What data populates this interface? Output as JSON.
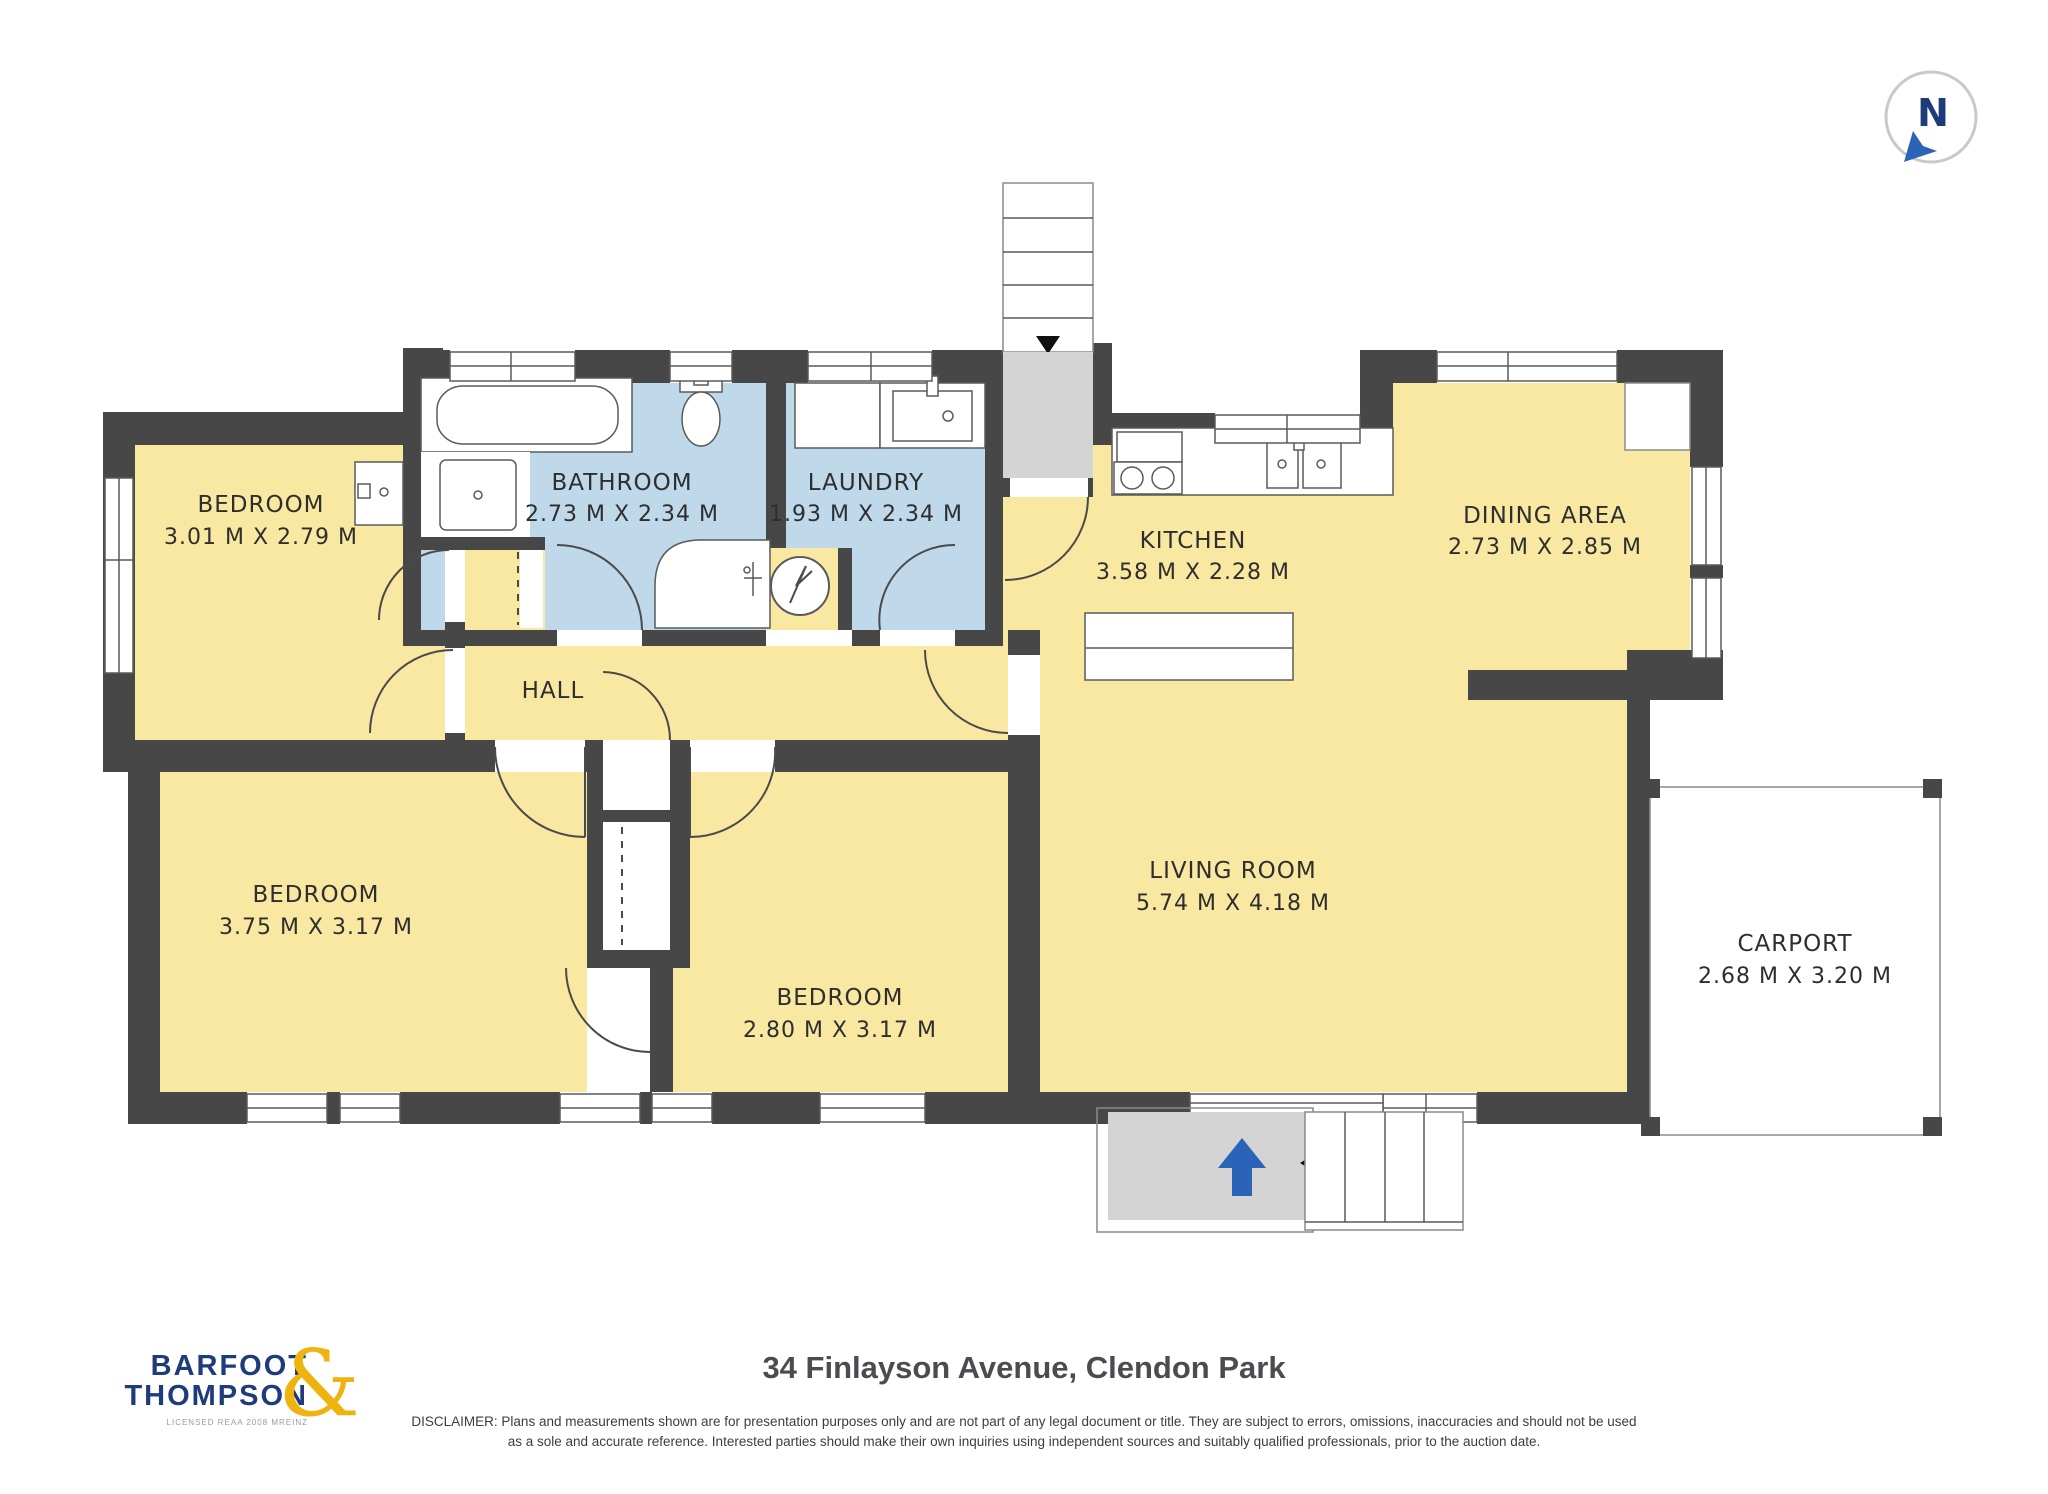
{
  "compass": {
    "label": "N"
  },
  "rooms": [
    {
      "name": "BEDROOM",
      "dims": "3.01 M X 2.79 M"
    },
    {
      "name": "BATHROOM",
      "dims": "2.73 M X 2.34 M"
    },
    {
      "name": "LAUNDRY",
      "dims": "1.93 M X 2.34 M"
    },
    {
      "name": "KITCHEN",
      "dims": "3.58 M X 2.28 M"
    },
    {
      "name": "DINING AREA",
      "dims": "2.73 M X 2.85 M"
    },
    {
      "name": "HALL",
      "dims": ""
    },
    {
      "name": "BEDROOM",
      "dims": "3.75 M X 3.17 M"
    },
    {
      "name": "BEDROOM",
      "dims": "2.80 M X 3.17 M"
    },
    {
      "name": "LIVING ROOM",
      "dims": "5.74 M X 4.18 M"
    },
    {
      "name": "CARPORT",
      "dims": "2.68 M X 3.20 M"
    }
  ],
  "branding": {
    "logo_line1": "BARFOOT",
    "logo_line2": "THOMPSON",
    "logo_amp": "&",
    "logo_sub": "LICENSED REAA 2008 MREINZ"
  },
  "footer": {
    "title": "34 Finlayson Avenue, Clendon Park",
    "disclaimer_line1": "DISCLAIMER: Plans and measurements shown are for presentation purposes only and are not part of any legal document or title. They are subject to errors, omissions, inaccuracies and should not be used",
    "disclaimer_line2": "as a sole and accurate reference. Interested parties should make their own inquiries using independent sources and suitably qualified professionals, prior to the auction date."
  },
  "colors": {
    "wall": "#474747",
    "floorYellow": "#F9E8A1",
    "wetBlue": "#BFD8EA",
    "landingGray": "#D4D4D4",
    "fixStroke": "#5a5a5a",
    "thinStroke": "#8a8a8a",
    "doorStroke": "#4a4a4a",
    "arrowBlue": "#2B63B9",
    "logoNavy": "#1E3C7B",
    "logoGold": "#EFB310",
    "textDark": "#2e2e2e",
    "titleGray": "#4A4C50"
  }
}
